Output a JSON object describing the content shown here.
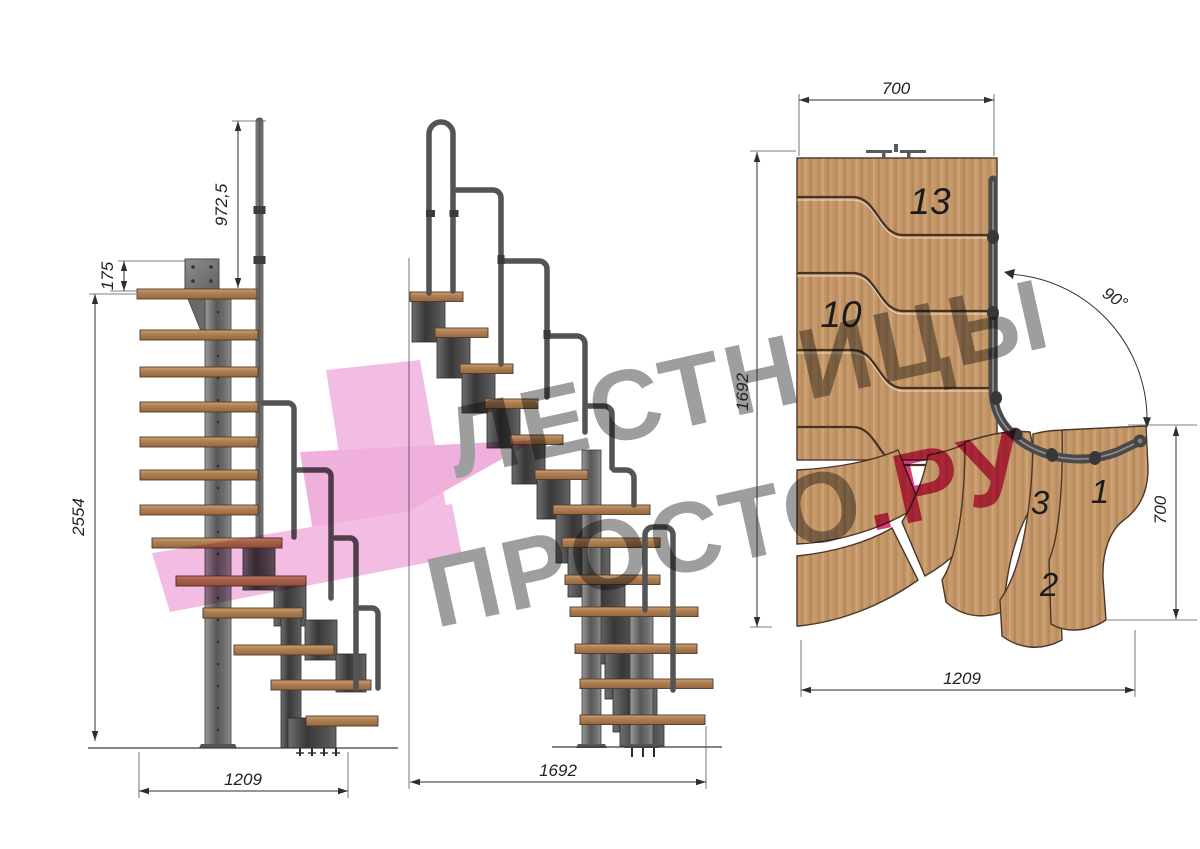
{
  "drawing": {
    "type": "technical staircase drawing, three views (side elevation, front elevation, plan)",
    "side_view": {
      "dim_handrail_height": "972,5",
      "dim_top_offset": "175",
      "dim_total_height": "2554",
      "dim_footprint_width": "1209"
    },
    "front_view": {
      "dim_flight_length": "1692"
    },
    "plan_view": {
      "dim_top_width": "700",
      "dim_left_length": "1692",
      "dim_turn_angle": "90°",
      "dim_right_width": "700",
      "dim_bottom_length": "1209",
      "step_13": "13",
      "step_10": "10",
      "step_3": "3",
      "step_1": "1",
      "step_2": "2"
    },
    "watermark": {
      "line1": "ЛЕСТНИЦЫ",
      "line2": "ПРОСТО",
      "line2_suffix": ".РУ"
    },
    "colors": {
      "background": "#ffffff",
      "wood": "#c49769",
      "metal": "#5a5a5a",
      "watermark_pink": "#f3bce2",
      "watermark_text_pink": "#d63e7c",
      "dimension_ink": "#222222"
    }
  }
}
